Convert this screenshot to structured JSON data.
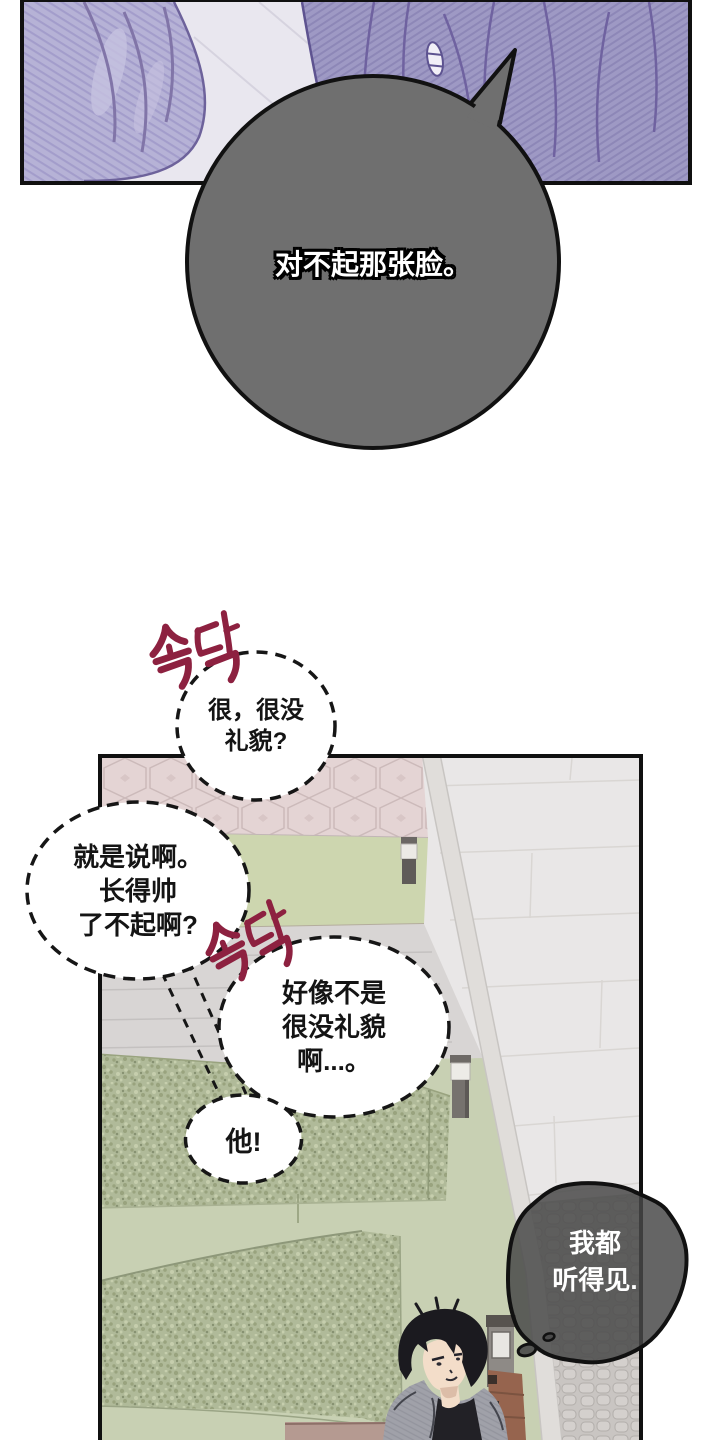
{
  "page": {
    "background": "#ffffff",
    "type": "manhwa-comic-page"
  },
  "panel_top": {
    "border_color": "#101010",
    "left_figure_color": "#b6b2d6",
    "right_figure_color": "#9e99c4",
    "pavement_color": "#e9e7ef"
  },
  "speech_bubble_main": {
    "shape": "ellipse-with-tail",
    "fill": "#6f6f6f",
    "outline": "#111111",
    "text": "对不起那张脸。",
    "text_color": "#ffffff"
  },
  "sfx": {
    "text": "속닥",
    "color": "#8d2140",
    "occurrences": 2
  },
  "whisper_bubbles": [
    {
      "style": "dashed-ellipse",
      "lines": [
        "很，很没",
        "礼貌?"
      ]
    },
    {
      "style": "dashed-ellipse",
      "lines": [
        "就是说啊。",
        "长得帅",
        "了不起啊?"
      ]
    },
    {
      "style": "dashed-ellipse",
      "lines": [
        "好像不是",
        "很没礼貌",
        "啊...。"
      ]
    },
    {
      "style": "dashed-ellipse",
      "lines": [
        "他!"
      ]
    }
  ],
  "thought_bubble": {
    "shape": "cloud",
    "fill": "#4a4a4a",
    "outline": "#111111",
    "lines": [
      "我都",
      "听得见."
    ],
    "text_color": "#ffffff"
  },
  "panel_bottom": {
    "border_color": "#101010",
    "scene": {
      "pink_pavement": "#e4d4d4",
      "grass_strip": "#cdd6af",
      "walkway": "#e9e7e7",
      "hedge": "#b0ba99",
      "cobbles": "#c9c5c2",
      "bench_wood": "#96644e",
      "lamp_body": "#76726e",
      "man_jacket": "#a0a1a9",
      "man_shirt": "#222126",
      "man_hair": "#1b1a1f",
      "man_skin": "#f3ddc9"
    }
  }
}
